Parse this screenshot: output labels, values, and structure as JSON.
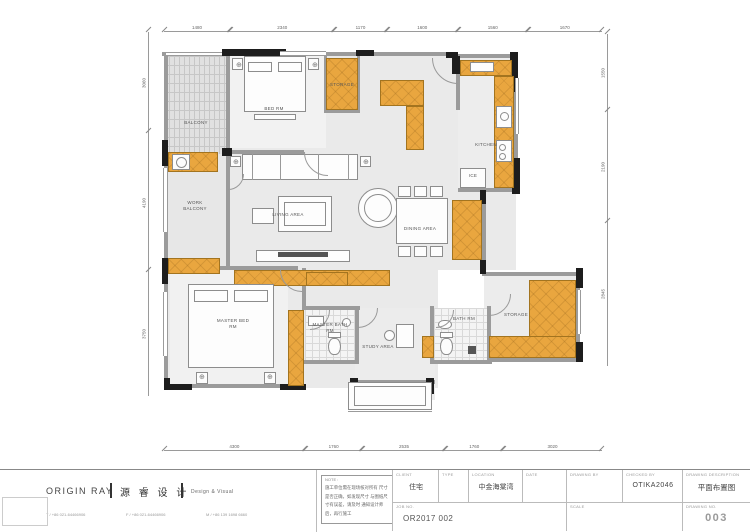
{
  "plan": {
    "labels": {
      "balcony": "BALCONY",
      "bed_rm": "BED RM",
      "storage_top": "STORAGE",
      "kitchen": "KITCHEN",
      "ice": "ICE",
      "work_balcony": "WORK BALCONY",
      "living": "LIVING AREA",
      "dining": "DINING AREA",
      "master_bed": "MASTER BED RM",
      "master_bath": "MASTER BATH RM",
      "study": "STUDY AREA",
      "bath": "BATH RM",
      "storage_bottom": "STORAGE"
    },
    "symbols": {
      "ceiling_light": "⊕"
    },
    "dimensions": {
      "top": [
        1480,
        2340,
        1170,
        1600,
        1560,
        1670
      ],
      "bottom": [
        4300,
        1760,
        2535,
        1760,
        3020
      ],
      "left": [
        3060,
        4190,
        3750
      ],
      "right": [
        1550,
        2190,
        2845
      ]
    },
    "colors": {
      "cabinet": "#e9a63f",
      "wall": "#9b9b9b",
      "structure": "#1d1d1d"
    }
  },
  "titleblock": {
    "logo": {
      "name_en": "ORIGIN RAY",
      "name_cn": "源 睿 设 计",
      "tagline": "Design & Visual",
      "contact_t": "T / +86 021-64466906",
      "contact_f": "F / +86 021-64466906",
      "contact_m": "M / +86 139 1698 6660"
    },
    "note": {
      "label": "NOTE :",
      "lines": "施工单位需在现场核对所有 尺寸是否正确，如发现尺寸 与图纸尺寸有误差，请及时 通知设计师后，再行施工"
    },
    "fields": {
      "client": {
        "label": "CLIENT",
        "value": "住宅"
      },
      "type": {
        "label": "TYPE",
        "value": ""
      },
      "location": {
        "label": "LOCATION",
        "value": "中金海棠湾"
      },
      "date": {
        "label": "DATE",
        "value": ""
      },
      "job_no": {
        "label": "JOB NO.",
        "value": "OR2017 002"
      },
      "drawing_by": {
        "label": "DRAWING BY",
        "value": ""
      },
      "checked_by": {
        "label": "CHECKED BY",
        "value": "OTIKA2046"
      },
      "drawing_description": {
        "label": "DRAWING DESCRIPTION",
        "value": "平面布置图"
      },
      "scale": {
        "label": "SCALE",
        "value": ""
      },
      "drawing_no": {
        "label": "DRAWING NO.",
        "value": "003"
      }
    }
  }
}
